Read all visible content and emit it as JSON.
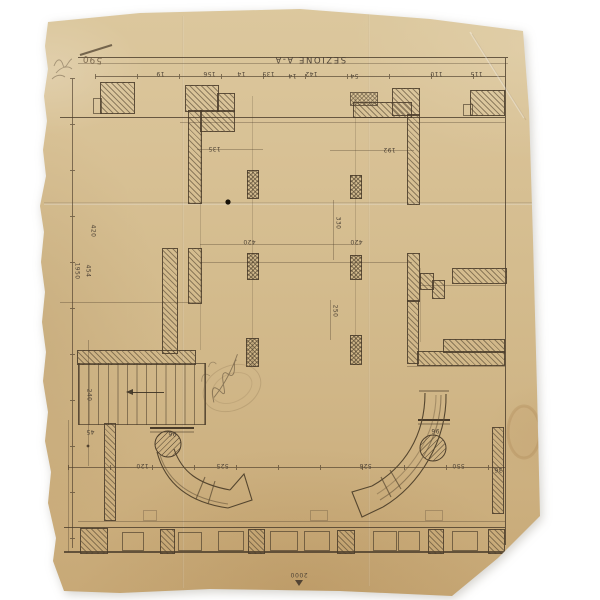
{
  "title": "SEZIONE A-A",
  "scale_label": "2000",
  "handwritten_number": "590",
  "dim_labels": [
    {
      "t": "19",
      "x": 156,
      "y": 70
    },
    {
      "t": "156",
      "x": 203,
      "y": 70
    },
    {
      "t": "14",
      "x": 237,
      "y": 70
    },
    {
      "t": "135",
      "x": 262,
      "y": 70
    },
    {
      "t": "14",
      "x": 288,
      "y": 72
    },
    {
      "t": "142",
      "x": 305,
      "y": 70
    },
    {
      "t": "54",
      "x": 350,
      "y": 72
    },
    {
      "t": "110",
      "x": 430,
      "y": 70
    },
    {
      "t": "115",
      "x": 470,
      "y": 70
    },
    {
      "t": "1950",
      "x": 68,
      "y": 268,
      "v": true
    },
    {
      "t": "454",
      "x": 81,
      "y": 268,
      "v": true
    },
    {
      "t": "420",
      "x": 86,
      "y": 228,
      "v": true
    },
    {
      "t": "240",
      "x": 82,
      "y": 392,
      "v": true
    },
    {
      "t": "45",
      "x": 86,
      "y": 428
    },
    {
      "t": "135",
      "x": 208,
      "y": 145
    },
    {
      "t": "192",
      "x": 383,
      "y": 146
    },
    {
      "t": "420",
      "x": 243,
      "y": 238
    },
    {
      "t": "420",
      "x": 350,
      "y": 238
    },
    {
      "t": "330",
      "x": 331,
      "y": 220,
      "v": true
    },
    {
      "t": "250",
      "x": 328,
      "y": 308,
      "v": true
    },
    {
      "t": "96",
      "x": 168,
      "y": 430
    },
    {
      "t": "96",
      "x": 431,
      "y": 427
    },
    {
      "t": "120",
      "x": 136,
      "y": 462
    },
    {
      "t": "525",
      "x": 216,
      "y": 462
    },
    {
      "t": "525",
      "x": 359,
      "y": 462
    },
    {
      "t": "550",
      "x": 452,
      "y": 462
    },
    {
      "t": "36",
      "x": 494,
      "y": 466
    }
  ]
}
